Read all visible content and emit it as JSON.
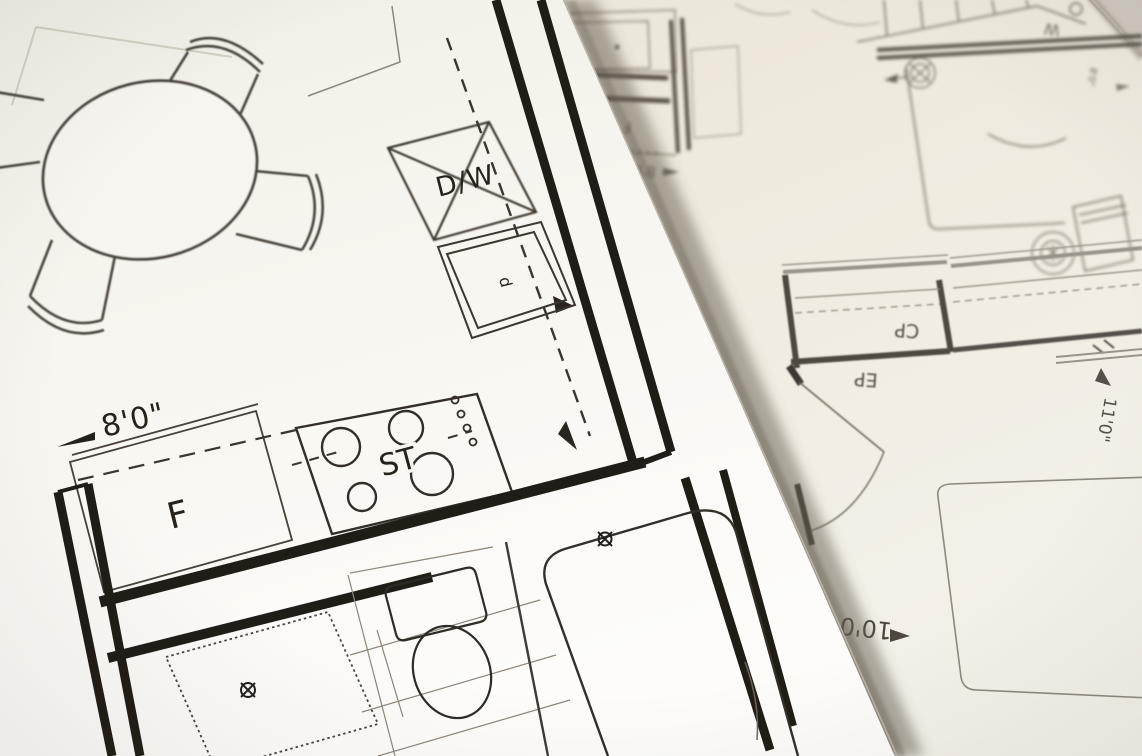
{
  "scene": {
    "title": "Two overlapping architectural floor plan sheets",
    "foreground_sheet_desc": "kitchen and bathroom plan, sharp, tilted",
    "background_sheet_desc": "bedroom and closet plan, rotated upside down, soft focus"
  },
  "foreground_plan": {
    "labels": {
      "dishwasher": "D/W",
      "stove": "ST",
      "fridge": "F",
      "sink_letter": "d",
      "width_dim": "8'0\""
    }
  },
  "background_plan": {
    "labels": {
      "fridge": "F",
      "top_dim": "8'0\"",
      "closet": "CP",
      "panel": "EP",
      "washer": "W",
      "right_dim": "11'0\"",
      "bottom_dim": "10'0",
      "small_dim": "8'0\""
    }
  },
  "colors": {
    "backdrop": "#cfc9bf",
    "foreground_paper": "#faf8f3",
    "background_paper": "#efeade",
    "foreground_ink": "#23201b",
    "background_ink": "#857e72",
    "background_wall": "#4e483f"
  }
}
